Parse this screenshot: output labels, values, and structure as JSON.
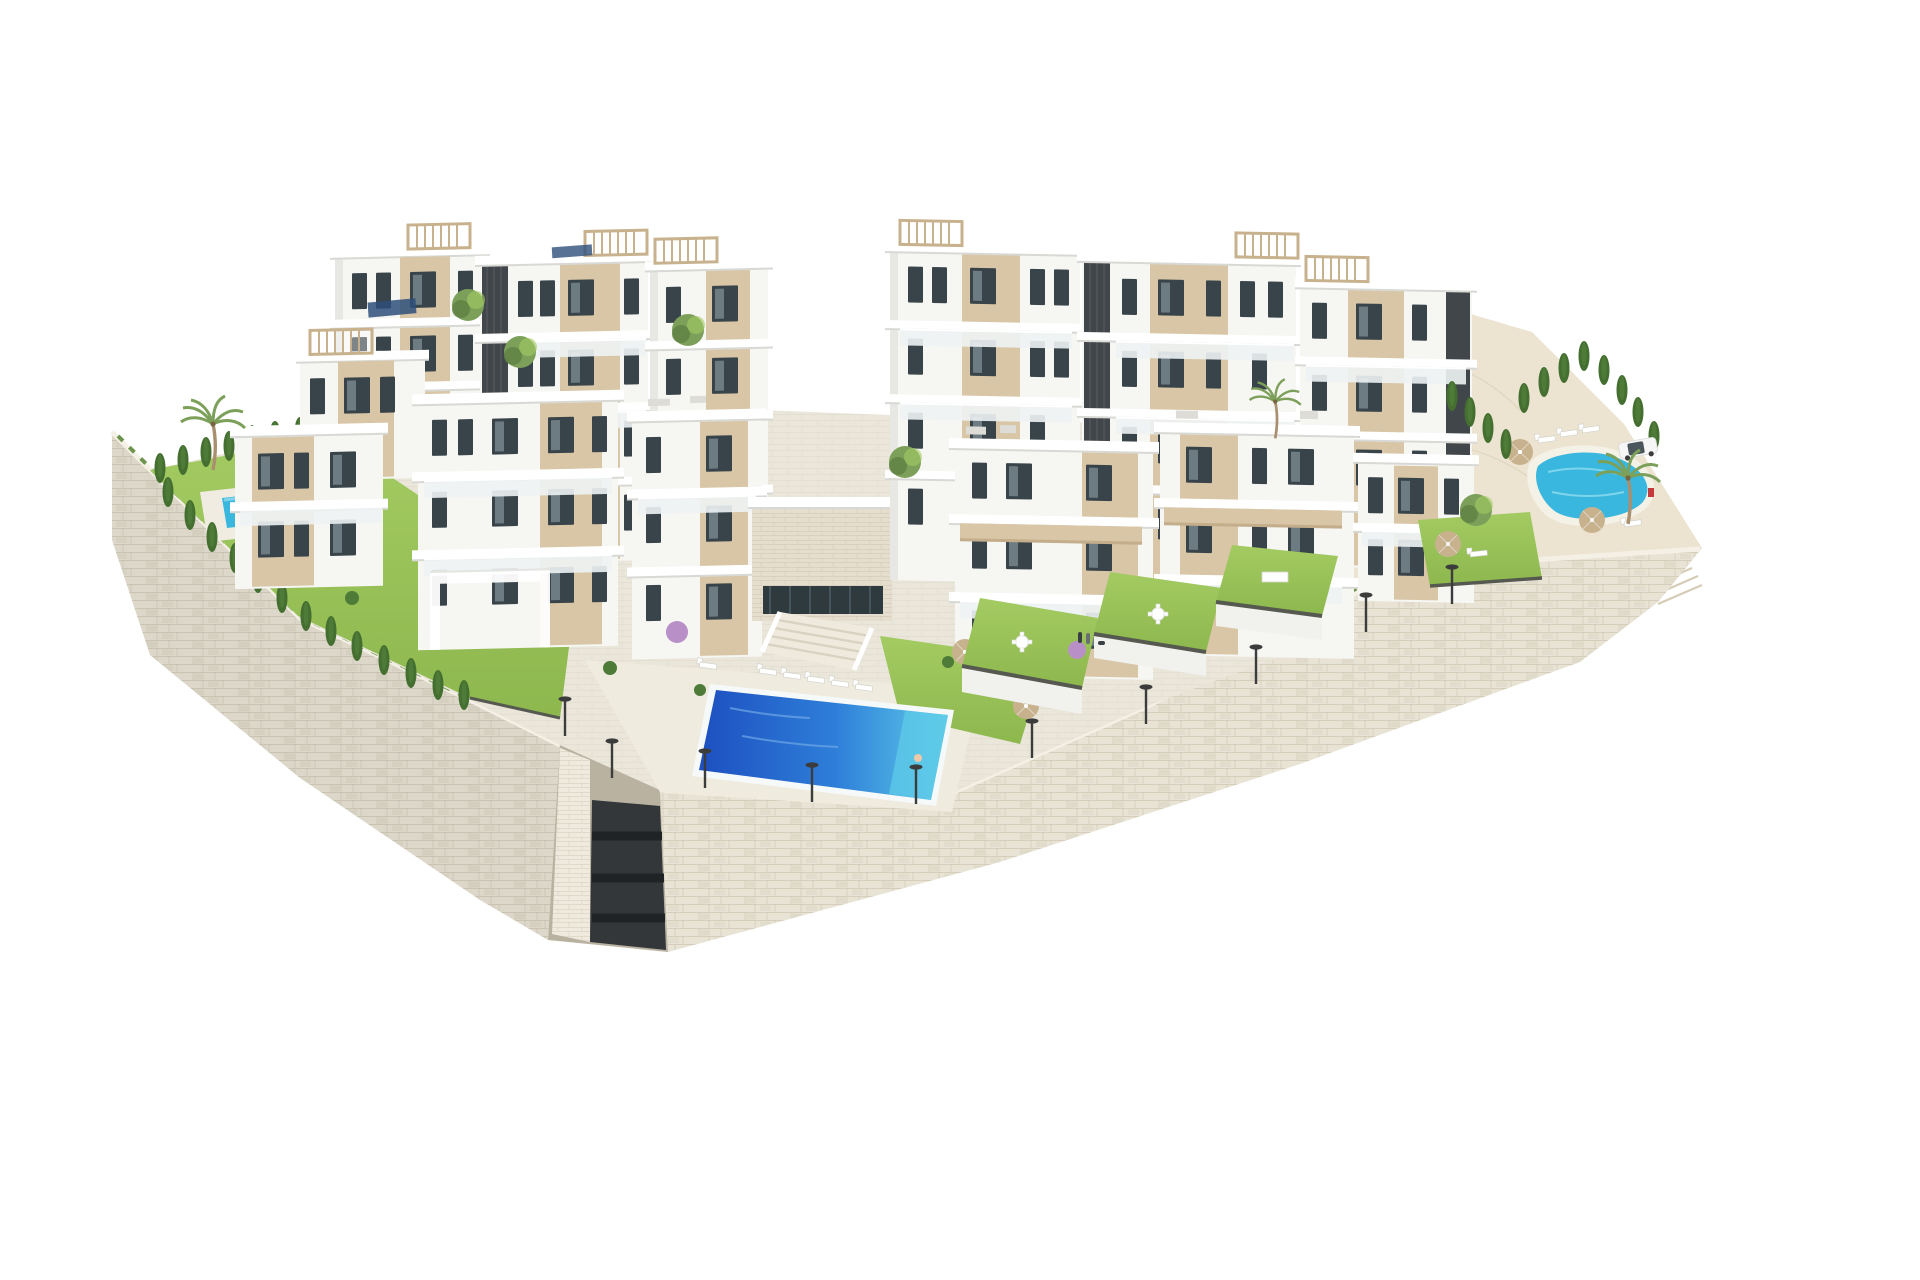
{
  "scene": {
    "type": "architectural-3d-render",
    "subject": "modern hillside apartment complex on stone retaining-wall plinth",
    "background": "plain white",
    "elements": [
      {
        "name": "apartment-building-block",
        "count": 12,
        "style": "white cubic volumes, beige wall panels, dark vertical slat accents, glass balconies, rooftop wood pergolas"
      },
      {
        "name": "swimming-pool-central",
        "shape": "rectangular",
        "count": 1
      },
      {
        "name": "swimming-pool-left-garden",
        "shape": "rectangular-small",
        "count": 1
      },
      {
        "name": "swimming-pool-right-lagoon",
        "shape": "organic",
        "count": 1
      },
      {
        "name": "private-garden-lawn",
        "count": 6
      },
      {
        "name": "stone-retaining-wall",
        "count": 2,
        "style": "dry-stacked cream stone, curved silhouette"
      },
      {
        "name": "stairwell-recess",
        "count": 1
      },
      {
        "name": "palm-tree",
        "count": 4
      },
      {
        "name": "cypress-hedge-tree",
        "count": 28
      },
      {
        "name": "leafy-tree",
        "count": 5
      },
      {
        "name": "flowering-purple-shrub",
        "count": 2
      },
      {
        "name": "sun-lounger",
        "count": 16
      },
      {
        "name": "parasol",
        "count": 6
      },
      {
        "name": "street-lamp",
        "count": 10
      },
      {
        "name": "white-suv-car",
        "count": 1
      },
      {
        "name": "pedestrians-with-dog",
        "count": 1
      },
      {
        "name": "swimmer-red",
        "count": 1
      },
      {
        "name": "rooftop-solar-panel",
        "count": 2
      },
      {
        "name": "outdoor-dining-set",
        "count": 3
      }
    ]
  },
  "palette": {
    "bg": "#ffffff",
    "stone": "#e8e3d4",
    "stoneLine": "#cfc7b3",
    "stoneDark": "#d8d1bf",
    "pave": "#eae6da",
    "paveLight": "#efebdf",
    "paveLine": "#d9d3c4",
    "sand": "#ece4d1",
    "grass": "#8db84e",
    "grassLight": "#a3cb62",
    "grassDark": "#6f9a3e",
    "hedge": "#4e7b37",
    "cypress": "#456f31",
    "poolDeep": "#1d4fc0",
    "poolMid": "#2e7fd9",
    "poolLight": "#5fcbe8",
    "poolSmall": "#3ab7de",
    "white": "#fbfbf9",
    "face": "#f6f6f3",
    "faceShade": "#e7e7e4",
    "slab": "#ffffff",
    "slabLine": "#d8d8d4",
    "beige": "#d8c6a6",
    "beigeDark": "#c3ad8a",
    "darkSlat": "#41464a",
    "win": "#39444a",
    "glass": "#c2d2d7",
    "railing": "#eef3f4",
    "tan": "#c8b28e",
    "lamp": "#3c3c3c",
    "treeGreen": "#7ca05a",
    "treeDark": "#5e7f42",
    "purple": "#b98fc8",
    "red": "#c43a3a",
    "car": "#f6f6f6",
    "shadow": "#d9d6cc"
  }
}
